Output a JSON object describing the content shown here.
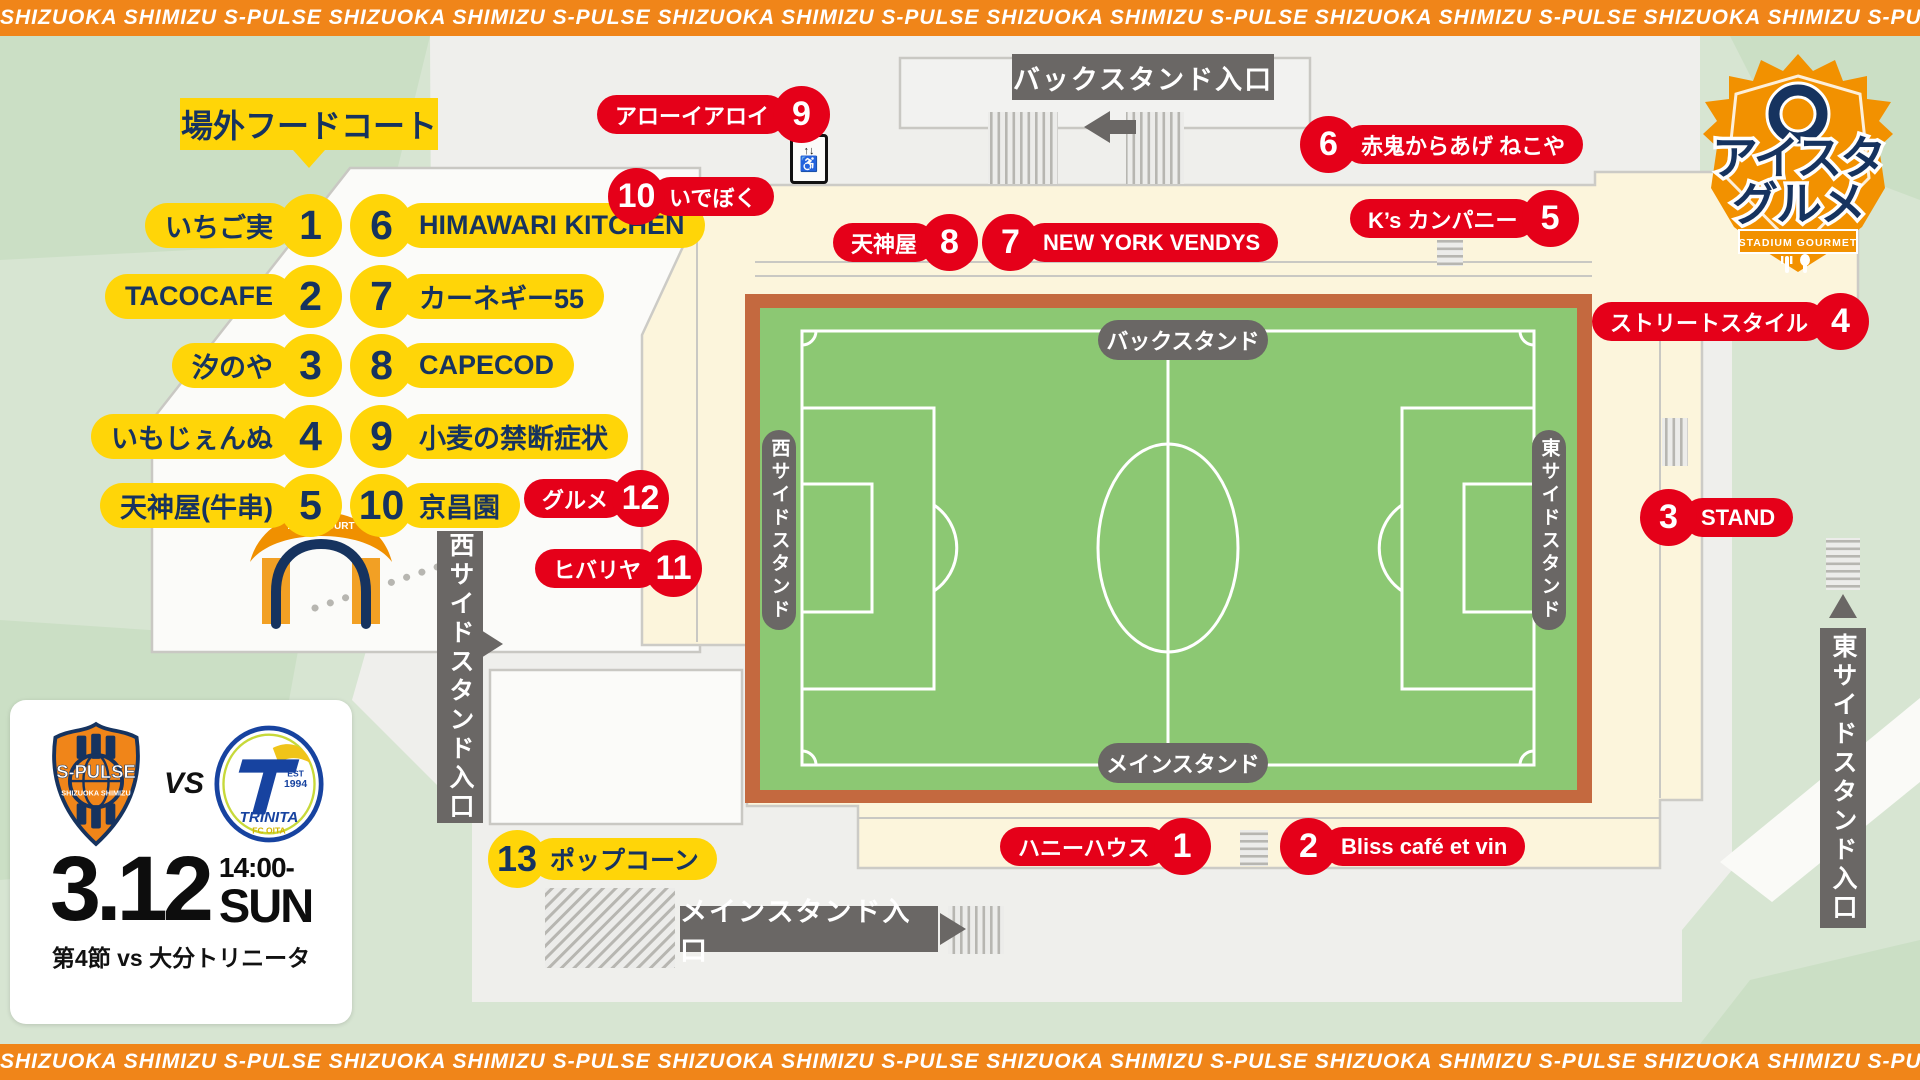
{
  "banner": {
    "phrase": "SHIZUOKA SHIMIZU S-PULSE"
  },
  "logo": {
    "line1": "アイスタ",
    "line2": "グルメ",
    "ribbon": "STADIUM GOURMET"
  },
  "food_court": {
    "title": "場外フードコート",
    "gate_text": "FOOD COURT",
    "items": [
      {
        "num": "1",
        "label": "いちご実",
        "side": "right"
      },
      {
        "num": "2",
        "label": "TACOCAFE",
        "side": "right"
      },
      {
        "num": "3",
        "label": "汐のや",
        "side": "right"
      },
      {
        "num": "4",
        "label": "いもじぇんぬ",
        "side": "right"
      },
      {
        "num": "5",
        "label": "天神屋(牛串)",
        "side": "right"
      },
      {
        "num": "6",
        "label": "HIMAWARI KITCHEN",
        "side": "left"
      },
      {
        "num": "7",
        "label": "カーネギー55",
        "side": "left"
      },
      {
        "num": "8",
        "label": "CAPECOD",
        "side": "left"
      },
      {
        "num": "9",
        "label": "小麦の禁断症状",
        "side": "left"
      },
      {
        "num": "10",
        "label": "京昌園",
        "side": "left"
      }
    ]
  },
  "map": {
    "badges": [
      {
        "id": "arroi",
        "num": "9",
        "label": "アローイアロイ",
        "color": "red",
        "side": "right"
      },
      {
        "id": "ideboku",
        "num": "10",
        "label": "いでぼく",
        "color": "red",
        "side": "left"
      },
      {
        "id": "tenjinya",
        "num": "8",
        "label": "天神屋",
        "color": "red",
        "side": "right"
      },
      {
        "id": "nyv",
        "num": "7",
        "label": "NEW YORK VENDYS",
        "color": "red",
        "side": "left"
      },
      {
        "id": "akaoni",
        "num": "6",
        "label": "赤鬼からあげ ねこや",
        "color": "red",
        "side": "left"
      },
      {
        "id": "ks",
        "num": "5",
        "label": "K’s カンパニー",
        "color": "red",
        "side": "right"
      },
      {
        "id": "street",
        "num": "4",
        "label": "ストリートスタイル",
        "color": "red",
        "side": "right"
      },
      {
        "id": "stand3",
        "num": "3",
        "label": "STAND",
        "color": "red",
        "side": "left"
      },
      {
        "id": "gurume",
        "num": "12",
        "label": "グルメ",
        "color": "red",
        "side": "right"
      },
      {
        "id": "hibariya",
        "num": "11",
        "label": "ヒバリヤ",
        "color": "red",
        "side": "right"
      },
      {
        "id": "honey",
        "num": "1",
        "label": "ハニーハウス",
        "color": "red",
        "side": "right"
      },
      {
        "id": "bliss",
        "num": "2",
        "label": "Bliss café et vin",
        "color": "red",
        "side": "left"
      },
      {
        "id": "popcorn",
        "num": "13",
        "label": "ポップコーン",
        "color": "yellow",
        "side": "left"
      }
    ],
    "stands": {
      "back": "バックスタンド",
      "main": "メインスタンド",
      "west": "西サイドスタンド",
      "east": "東サイドスタンド"
    },
    "entrances": {
      "back": "バックスタンド入口",
      "main": "メインスタンド入口",
      "west": "西サイドスタンド入口",
      "east": "東サイドスタンド入口"
    },
    "icons": {
      "elevator_arrows": "↑↓",
      "wheelchair": "♿"
    }
  },
  "match": {
    "date": "3.12",
    "time": "14:00-",
    "day": "SUN",
    "detail": "第4節 vs 大分トリニータ",
    "vs": "VS",
    "home": {
      "name": "S-PULSE",
      "sub": "SHIZUOKA SHIMIZU"
    },
    "away": {
      "name": "TRINITA",
      "sub": "FC OITA",
      "est_label": "EST",
      "est_year": "1994"
    }
  },
  "colors": {
    "accent_orange": "#f08519",
    "badge_red": "#e50019",
    "badge_yellow": "#ffd508",
    "navy": "#16335f",
    "pitch_green": "#8cc873",
    "track_brown": "#c4693f",
    "label_gray": "#6a6765"
  }
}
